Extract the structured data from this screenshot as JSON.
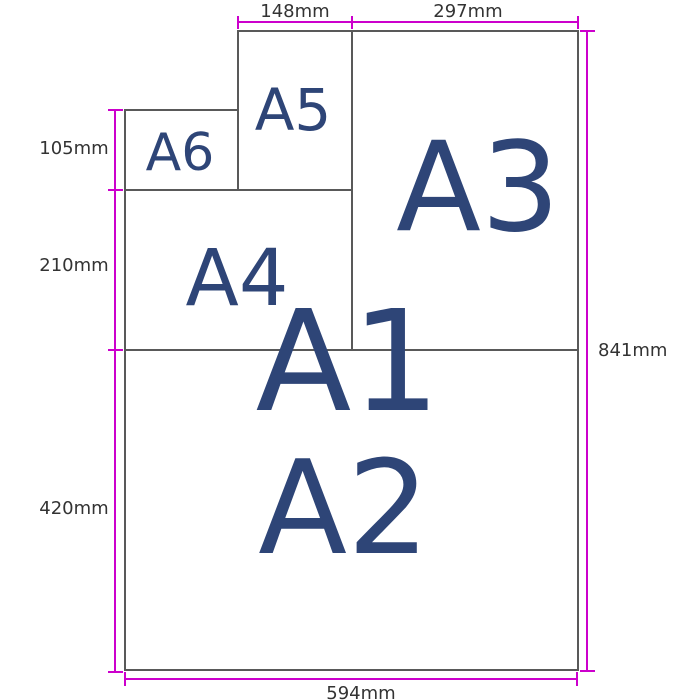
{
  "diagram": {
    "type": "paper-size-comparison",
    "labels": {
      "a1": "A1",
      "a2": "A2",
      "a3": "A3",
      "a4": "A4",
      "a5": "A5",
      "a6": "A6"
    },
    "dimensions": {
      "a5_width": "148mm",
      "a3_width": "297mm",
      "a6_height": "105mm",
      "a4_height": "210mm",
      "a2_height": "420mm",
      "a1_height": "841mm",
      "a1_width": "594mm"
    },
    "colors": {
      "dimension_accent": "#cc00cc",
      "paper_border": "#595959",
      "paper_label": "#2e4577",
      "dimension_text": "#333333",
      "background": "#ffffff"
    }
  }
}
